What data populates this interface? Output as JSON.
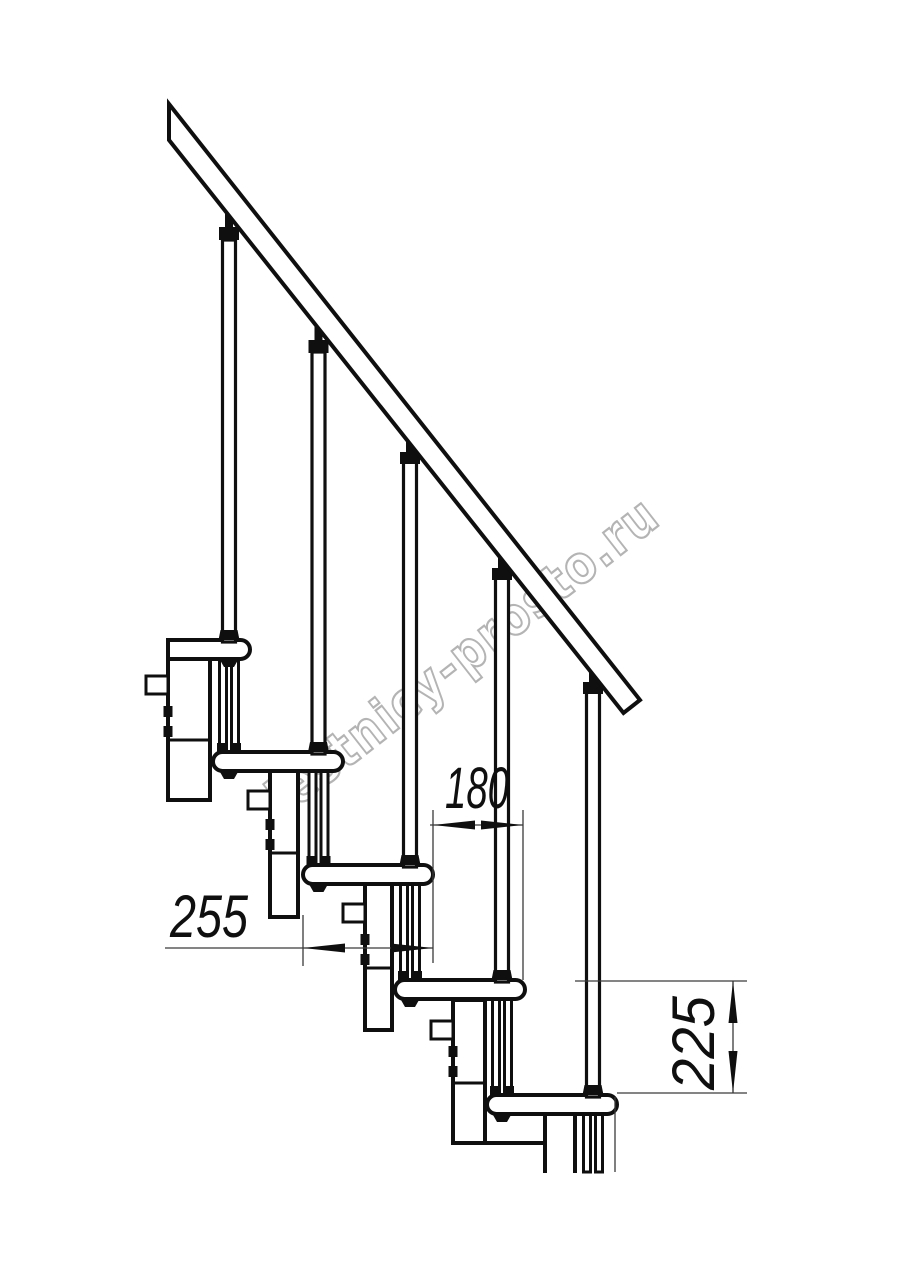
{
  "page": {
    "background": "#ffffff",
    "description": "Side-view technical drawing of a modular staircase with handrail, balusters, five treads and dimension annotations"
  },
  "colors": {
    "line": "#0f0f0f",
    "dimension_line": "#3a3a3a",
    "watermark": "#b4b4b4",
    "fill": "#ffffff"
  },
  "watermark": {
    "text": "lestnicy-prosto.ru"
  },
  "dimensions": {
    "step_run": {
      "label": "180"
    },
    "tread_depth": {
      "label": "255"
    },
    "step_rise": {
      "label": "225"
    }
  },
  "drawing": {
    "treads_visible": 5,
    "balusters_visible": 5,
    "handrail": "diagonal handrail band, top-left to mid-right"
  }
}
